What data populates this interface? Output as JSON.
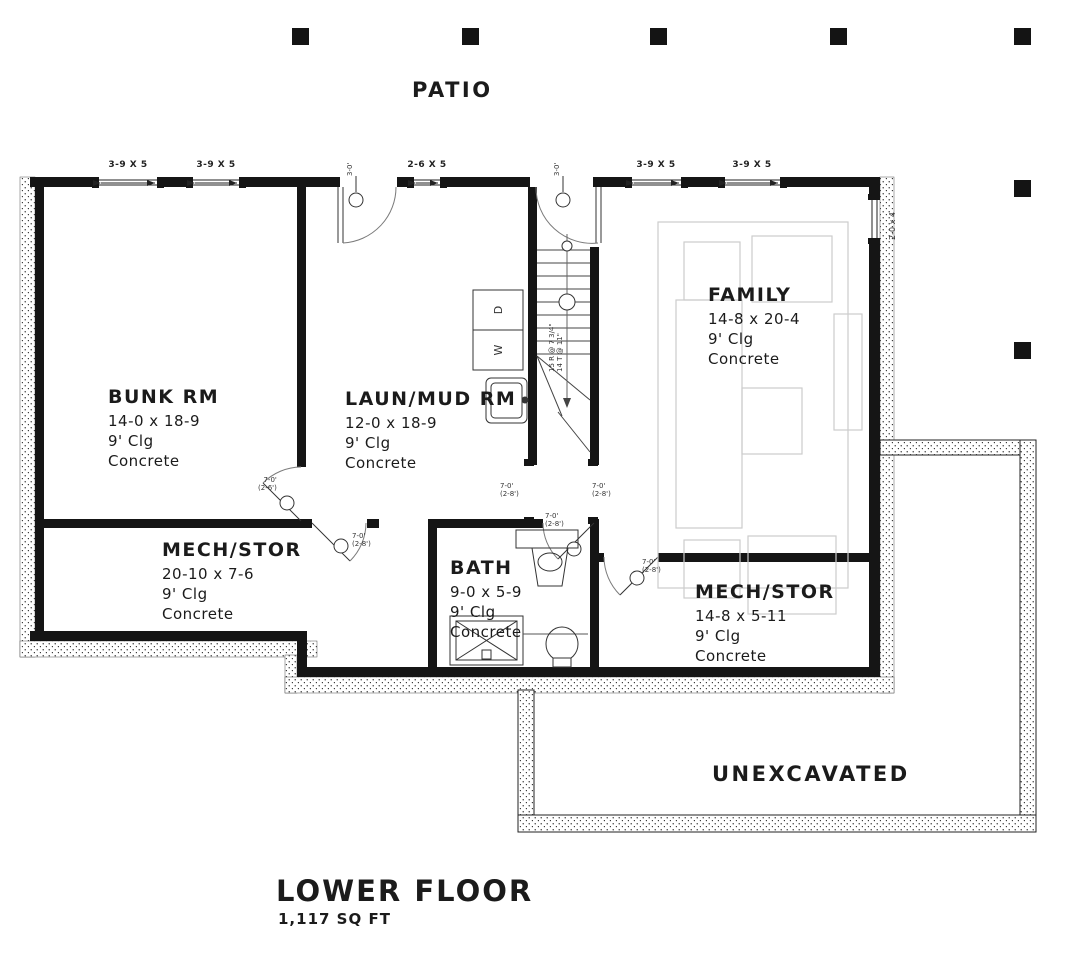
{
  "labels": {
    "patio": "PATIO",
    "unexcavated": "UNEXCAVATED",
    "title": "LOWER FLOOR",
    "area": "1,117 SQ FT"
  },
  "rooms": [
    {
      "name": "BUNK RM",
      "dims": "14-0 x 18-9",
      "clg": "9' Clg",
      "floor": "Concrete"
    },
    {
      "name": "LAUN/MUD RM",
      "dims": "12-0 x 18-9",
      "clg": "9' Clg",
      "floor": "Concrete"
    },
    {
      "name": "FAMILY",
      "dims": "14-8 x 20-4",
      "clg": "9' Clg",
      "floor": "Concrete"
    },
    {
      "name": "MECH/STOR",
      "dims": "20-10 x 7-6",
      "clg": "9' Clg",
      "floor": "Concrete"
    },
    {
      "name": "BATH",
      "dims": "9-0 x 5-9",
      "clg": "9' Clg",
      "floor": "Concrete"
    },
    {
      "name": "MECH/STOR",
      "dims": "14-8 x 5-11",
      "clg": "9' Clg",
      "floor": "Concrete"
    }
  ],
  "windows": {
    "w1": "3-9 X 5",
    "w2": "3-9 X 5",
    "w3": "2-6 X 5",
    "w4": "3-9 X 5",
    "w5": "3-9 X 5",
    "right": "2-0 x 4"
  },
  "doors": {
    "exterior_tag": "3-0'",
    "height_tag": "7-0'",
    "width_tag_28": "(2-8')",
    "width_tag_26": "(2-6')"
  },
  "stairs": {
    "note1": "15 R @ 7 3/4\"",
    "note2": "14 T @ 11\""
  },
  "appliances": {
    "dryer": "D",
    "washer": "W"
  },
  "colors": {
    "wall": "#1b1b1b",
    "furniture": "#cccccc",
    "annotation": "#333333"
  }
}
